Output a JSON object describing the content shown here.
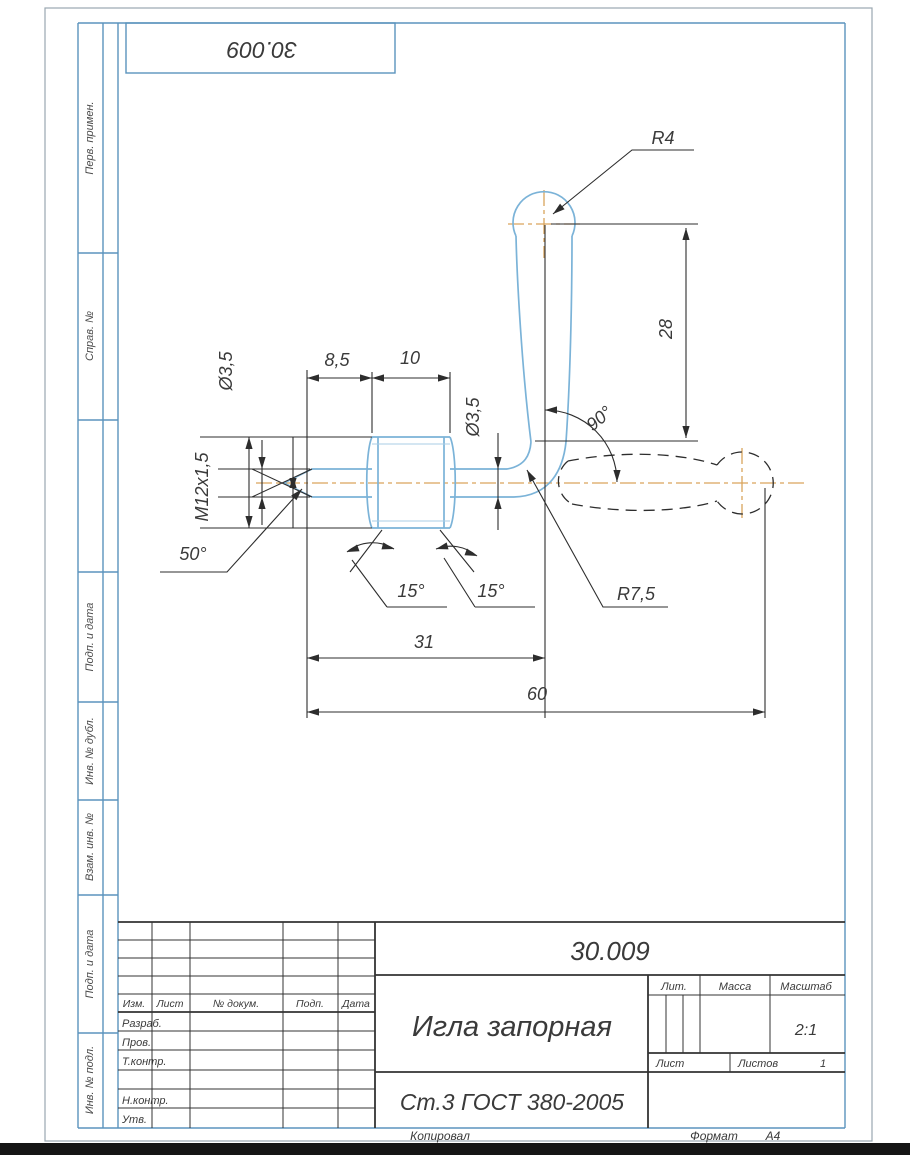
{
  "stamp_top": {
    "doc_number": "30.009"
  },
  "margin_labels": [
    "Перв. примен.",
    "Справ. №",
    "Подп. и дата",
    "Инв. № дубл.",
    "Взам. инв. №",
    "Подп. и дата",
    "Инв. № подл."
  ],
  "drawing": {
    "labels": {
      "radius_top": "R4",
      "height_28": "28",
      "len_8_5": "8,5",
      "len_10": "10",
      "dia_left": "Ø3,5",
      "thread": "M12x1,5",
      "dia_right": "Ø3,5",
      "angle_tip": "50°",
      "angle_chamfer_left": "15°",
      "angle_chamfer_right": "15°",
      "radius_bend": "R7,5",
      "len_31": "31",
      "len_60": "60",
      "angle_handle": "90°"
    }
  },
  "title_block": {
    "doc_number": "30.009",
    "part_name": "Игла запорная",
    "material": "Ст.3 ГОСТ 380-2005",
    "scale_value": "2:1",
    "sheets_value": "1",
    "headers": {
      "lit": "Лит.",
      "mass": "Масса",
      "scale": "Масштаб",
      "sheet": "Лист",
      "sheets": "Листов"
    },
    "rev_headers": [
      "Изм.",
      "Лист",
      "№ докум.",
      "Подп.",
      "Дата"
    ],
    "roles": [
      "Разраб.",
      "Пров.",
      "Т.контр.",
      "Н.контр.",
      "Утв."
    ]
  },
  "footer": {
    "copied": "Копировал",
    "format_label": "Формат",
    "format_value": "А4"
  },
  "colors": {
    "part_outline": "#7bb3d8",
    "part_thread": "#a9cde6",
    "centerline": "#d9a45c",
    "dimension": "#2d2d2d",
    "frame": "#5b93bd",
    "title_lines": "#333333",
    "text": "#3a3a3a",
    "border": "#9aa7b0"
  }
}
